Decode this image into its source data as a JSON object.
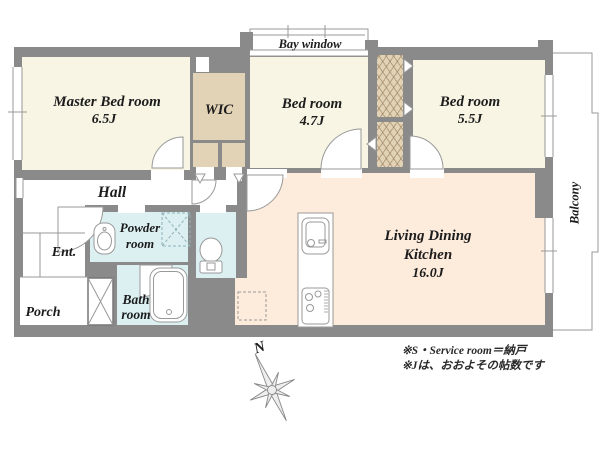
{
  "rooms": {
    "master_bedroom": {
      "name": "Master Bed room",
      "size": "6.5J"
    },
    "wic": {
      "name": "WIC"
    },
    "bedroom_2": {
      "name": "Bed room",
      "size": "4.7J"
    },
    "bedroom_3": {
      "name": "Bed room",
      "size": "5.5J"
    },
    "ldk": {
      "line1": "Living Dining",
      "line2": "Kitchen",
      "size": "16.0J"
    },
    "hall": {
      "name": "Hall"
    },
    "entrance": {
      "name": "Ent."
    },
    "porch": {
      "name": "Porch"
    },
    "powder_room": {
      "line1": "Powder",
      "line2": "room"
    },
    "bath_room": {
      "line1": "Bath",
      "line2": "room"
    },
    "bay_window": {
      "name": "Bay window"
    },
    "balcony": {
      "name": "Balcony"
    }
  },
  "compass": {
    "north_label": "N"
  },
  "notes": {
    "line1": "※S・Service room＝納戸",
    "line2": "※Jは、おおよその帖数です"
  },
  "colors": {
    "wall": "#8a8a8a",
    "bedroom_floor": "#f8f5e4",
    "closet_floor": "#e2d2b6",
    "ldk_floor": "#fdebdc",
    "wet_room_floor": "#dcf0f2",
    "outline": "#999999",
    "text": "#1c1c1c"
  }
}
